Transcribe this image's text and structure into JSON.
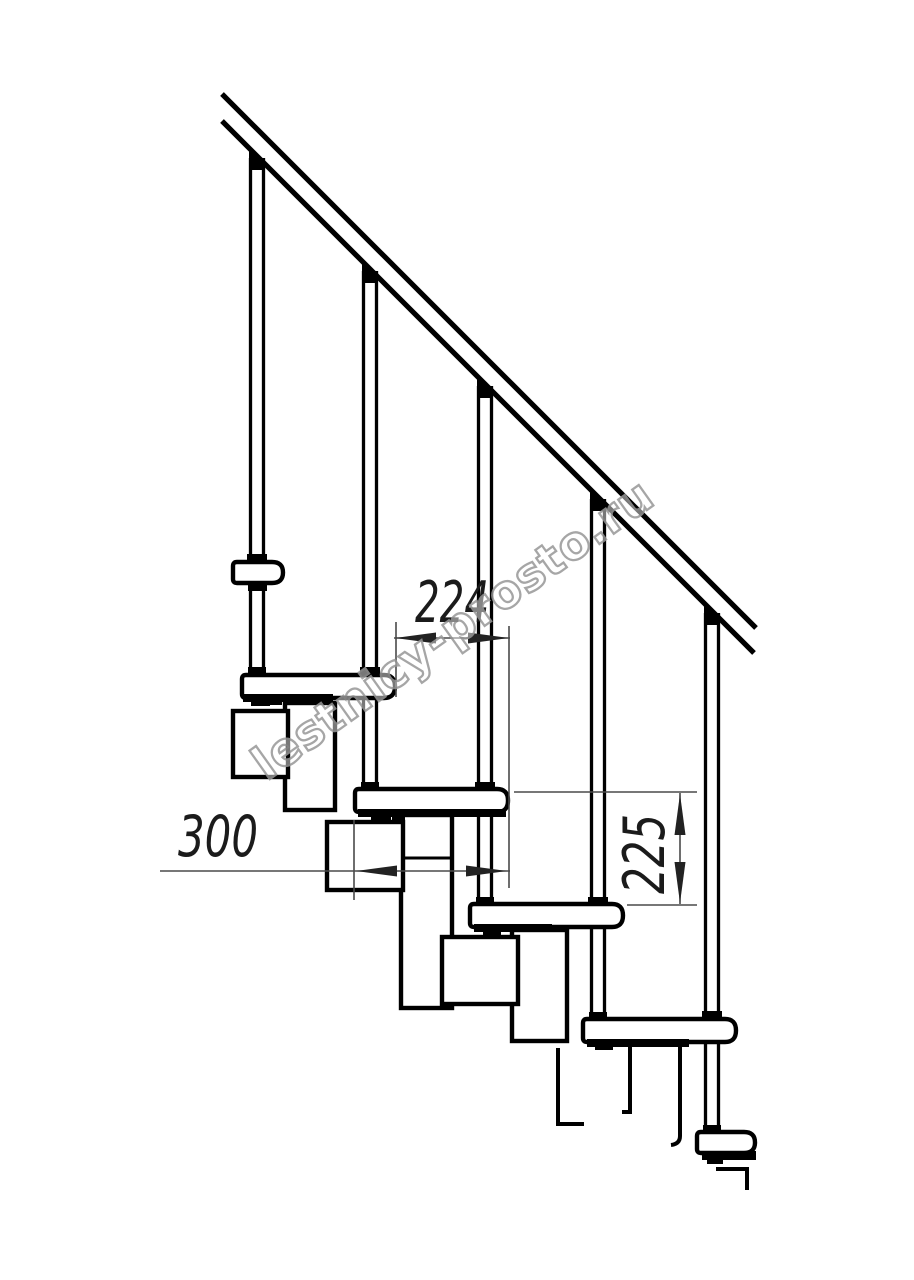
{
  "document": {
    "kind": "staircase-side-view-technical-drawing",
    "background_color": "#ffffff",
    "line_color": "#000000",
    "dimension_line_color": "#4a4a4a",
    "dimension_text_color": "#1b1b1b"
  },
  "dimensions": {
    "step_run": {
      "value": "224",
      "orientation": "horizontal"
    },
    "tread_depth": {
      "value": "300",
      "orientation": "horizontal"
    },
    "riser_height": {
      "value": "225",
      "orientation": "vertical"
    }
  },
  "figure": {
    "balusters_visible": 5,
    "treads_visible": 5,
    "handrail": "diagonal-45deg"
  },
  "watermark": {
    "text": "lestnicy-prosto.ru",
    "stroke_color": "#979797",
    "angle_deg": -35.5
  }
}
